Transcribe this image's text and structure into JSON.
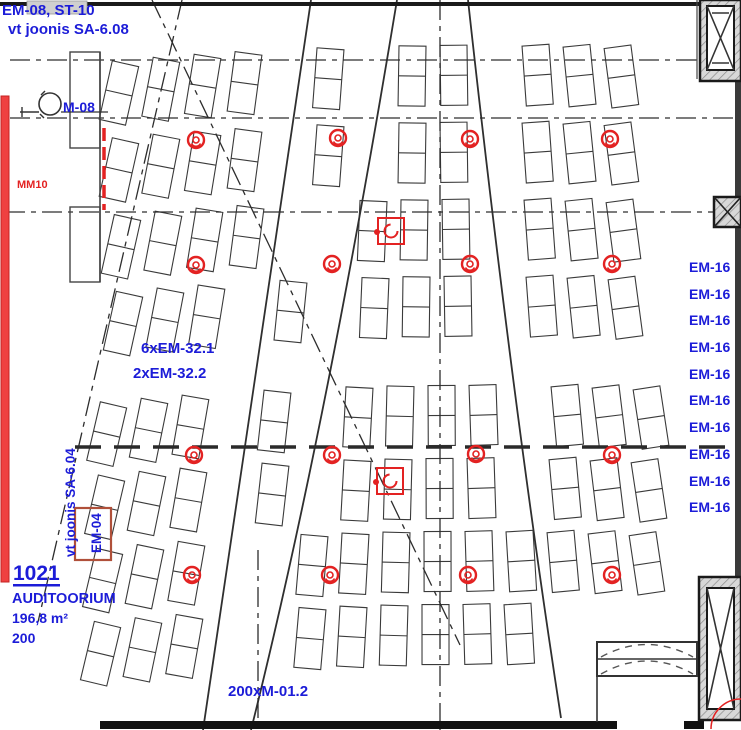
{
  "plan": {
    "top_left": {
      "line1": "EM-08, ST-10",
      "line2": "vt joonis SA-6.08"
    },
    "device_m08": "M-08",
    "mm10": "MM10",
    "fixtures": {
      "line1": "6xEM-32.1",
      "line2": "2xEM-32.2"
    },
    "right_labels": [
      "EM-16",
      "EM-16",
      "EM-16",
      "EM-16",
      "EM-16",
      "EM-16",
      "EM-16",
      "EM-16",
      "EM-16",
      "EM-16"
    ],
    "room": {
      "number": "1021",
      "name": "AUDITOORIUM",
      "area": "196,8 m²",
      "capacity": "200"
    },
    "em04": "EM-04",
    "ref_sa604": "vt joonis SA-6.04",
    "seats_label": "200xM-01.2",
    "colors": {
      "label_blue": "#1c1cd8",
      "line_red": "#e32222",
      "wall_dark": "#1a1a1a"
    }
  }
}
